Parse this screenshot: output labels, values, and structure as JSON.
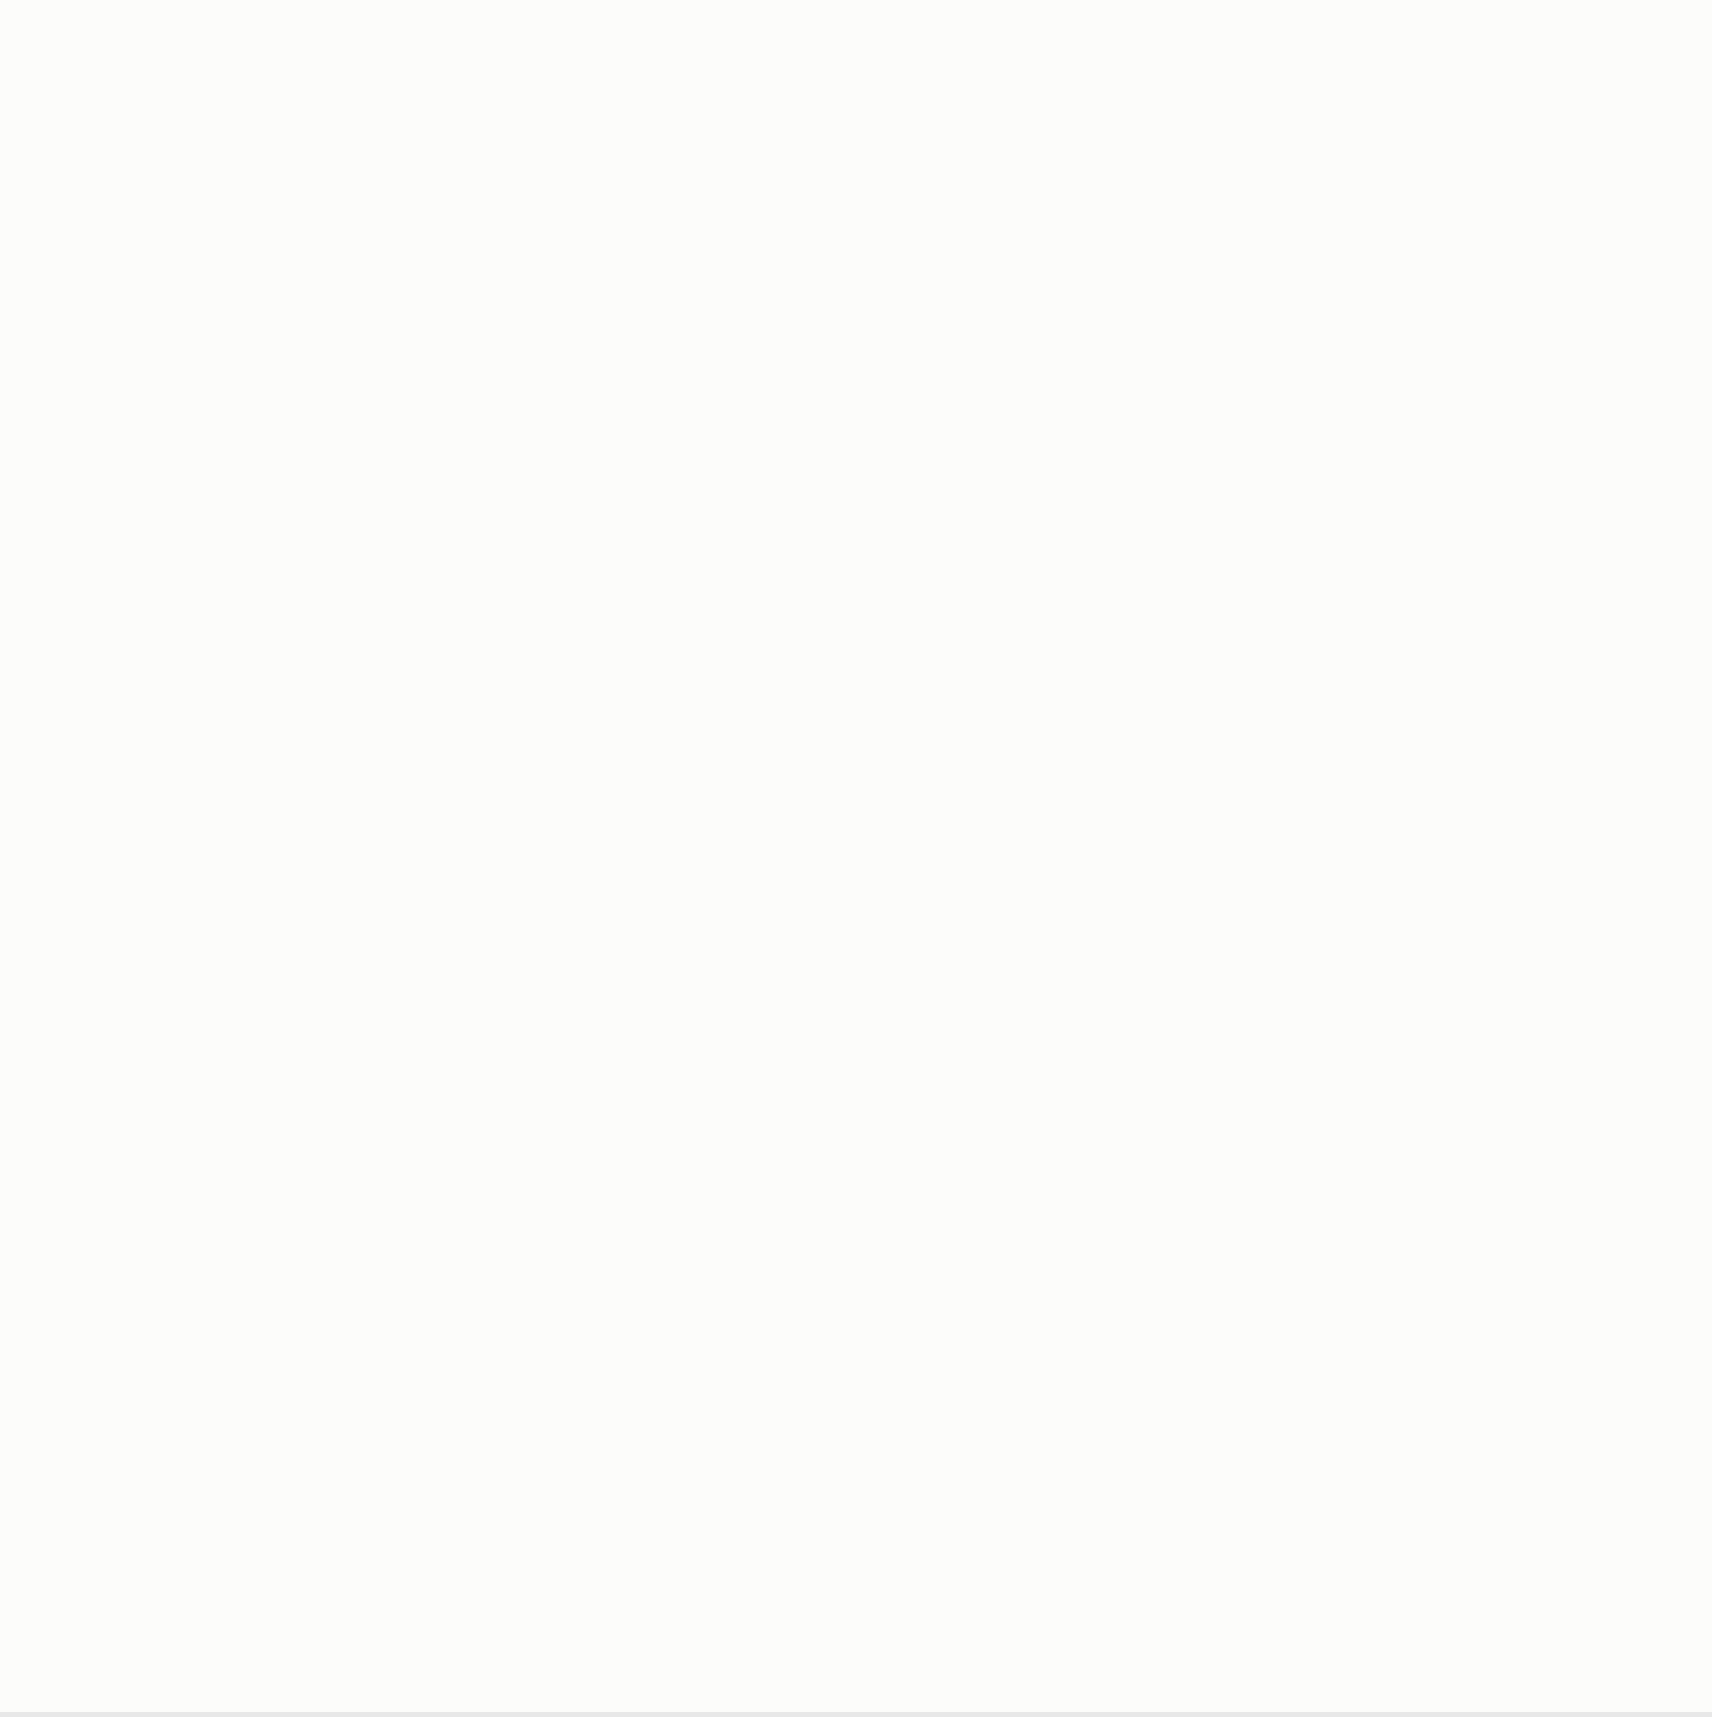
{
  "colors": {
    "red": "#d03224",
    "orange": "#e2801e",
    "magenta": "#c94fc0",
    "wall_blue": "#1e3f9e",
    "thin_blue": "#2f5fae",
    "hatch_gray": "#8f8f8f",
    "speckle_blue": "#79c0de",
    "pale_blue": "#d7e9f4",
    "ink": "#333333",
    "tree_green": "#6f9a60"
  },
  "labels": {
    "bosco_top": {
      "t": "BOSCO",
      "x": 578,
      "y": 16
    },
    "bosco_right": {
      "t": "BOSCO",
      "x": 1442,
      "y": 258
    },
    "parcel_1125": {
      "t": "1125",
      "x": 570,
      "y": 282,
      "rot": -80
    },
    "parcel_885": {
      "t": "885",
      "x": 1070,
      "y": 358,
      "rot": -76
    },
    "parcel_1122": {
      "t": "1122",
      "x": 506,
      "y": 1600,
      "rot": -73
    },
    "street": {
      "t": "Ronchetti",
      "x": 558,
      "y": 1612,
      "rot": -73
    },
    "north": {
      "t": "N",
      "x": 102,
      "y": 1503
    }
  },
  "markers": [
    {
      "t": "A",
      "x": 107,
      "y": 22,
      "o": "t"
    },
    {
      "t": "B",
      "x": 350,
      "y": 26,
      "o": "t"
    },
    {
      "t": "C",
      "x": 500,
      "y": 24,
      "o": "t"
    },
    {
      "t": "D",
      "x": 660,
      "y": 28,
      "o": "t"
    },
    {
      "t": "E",
      "x": 768,
      "y": 34,
      "o": "t"
    },
    {
      "t": "F",
      "x": 958,
      "y": 50,
      "o": "t"
    },
    {
      "t": "G",
      "x": 1100,
      "y": 53,
      "o": "t"
    },
    {
      "t": "H",
      "x": 1245,
      "y": 165,
      "o": "t"
    },
    {
      "t": "I",
      "x": 1432,
      "y": 322,
      "o": "t"
    },
    {
      "t": "L",
      "x": 1572,
      "y": 402,
      "o": "t"
    },
    {
      "t": "M",
      "x": 1592,
      "y": 502,
      "o": "r"
    },
    {
      "t": "N",
      "x": 1591,
      "y": 598,
      "o": "r"
    },
    {
      "t": "O",
      "x": 1594,
      "y": 838,
      "o": "r"
    },
    {
      "t": "P",
      "x": 1594,
      "y": 1005,
      "o": "r"
    },
    {
      "t": "Q",
      "x": 1600,
      "y": 1520,
      "o": "r"
    },
    {
      "t": "M",
      "x": 76,
      "y": 505,
      "o": "l"
    },
    {
      "t": "N",
      "x": 75,
      "y": 600,
      "o": "l"
    },
    {
      "t": "O",
      "x": 75,
      "y": 642,
      "o": "l"
    },
    {
      "t": "P",
      "x": 72,
      "y": 795,
      "o": "l"
    },
    {
      "t": "Q",
      "x": 68,
      "y": 1191,
      "o": "l"
    },
    {
      "t": "A",
      "x": 104,
      "y": 1304,
      "o": "l"
    },
    {
      "t": "B",
      "x": 344,
      "y": 1404,
      "o": "l"
    },
    {
      "t": "C",
      "x": 489,
      "y": 1442,
      "o": "b"
    },
    {
      "t": "D",
      "x": 650,
      "y": 1524,
      "o": "b"
    },
    {
      "t": "E",
      "x": 760,
      "y": 1567,
      "o": "b"
    },
    {
      "t": "F",
      "x": 954,
      "y": 1595,
      "o": "b"
    },
    {
      "t": "G",
      "x": 1104,
      "y": 1597,
      "o": "b"
    },
    {
      "t": "H",
      "x": 1277,
      "y": 1598,
      "o": "b"
    },
    {
      "t": "I",
      "x": 1475,
      "y": 1600,
      "o": "b"
    },
    {
      "t": "L",
      "x": 1570,
      "y": 1602,
      "o": "b"
    }
  ],
  "step_dims": [
    {
      "t": "605",
      "x": 305,
      "y": 516
    },
    {
      "t": "371",
      "x": 458,
      "y": 516
    },
    {
      "t": "514",
      "x": 641,
      "y": 516
    },
    {
      "t": "401",
      "x": 920,
      "y": 748
    },
    {
      "t": "571",
      "x": 1040,
      "y": 737
    },
    {
      "t": "514",
      "x": 1190,
      "y": 737
    },
    {
      "t": "411",
      "x": 1330,
      "y": 737
    }
  ],
  "colored_dims": [
    {
      "t": "293",
      "x": 150,
      "y": 884,
      "c": "red"
    },
    {
      "t": "290",
      "x": 1512,
      "y": 706,
      "c": "orange"
    },
    {
      "t": "490",
      "x": 391,
      "y": 1170,
      "c": "orange",
      "rot": -90
    },
    {
      "t": "490",
      "x": 1030,
      "y": 1300,
      "c": "orange",
      "rot": -90
    }
  ],
  "houses": [
    {
      "name": "CASA 1",
      "label": {
        "x": 330,
        "y": 1065
      },
      "variant": "A",
      "rect": {
        "x": 219,
        "y": 528,
        "w": 255,
        "h": 456
      },
      "level": "377,81",
      "level_pos": {
        "rx": 0.39,
        "ry": 0.455
      },
      "rooms": [
        {
          "t": [
            "cantina",
            "lavanderia",
            "10,5 mq"
          ],
          "rx": 0.27,
          "ry": 0.07
        },
        {
          "t": [
            "vano scala",
            "9,7 mq"
          ],
          "rx": 0.46,
          "ry": 0.35
        },
        {
          "t": [
            "atrio",
            "7,5 mq"
          ],
          "rx": 0.2,
          "ry": 0.46
        },
        {
          "t": [
            "corridoio",
            "4 mq"
          ],
          "rx": 0.43,
          "ry": 0.545
        },
        {
          "t": [
            "camera 1",
            "16 mq"
          ],
          "rx": 0.82,
          "ry": 0.455
        },
        {
          "t": [
            "bagno 1",
            "4,5 mq"
          ],
          "rx": 0.14,
          "ry": 0.66
        },
        {
          "t": [
            "bagno 2",
            "4,5 mq"
          ],
          "rx": 0.58,
          "ry": 0.66
        },
        {
          "t": [
            "camera 3",
            "12,5 mq"
          ],
          "rx": 0.215,
          "ry": 0.895
        },
        {
          "t": [
            "camera 2",
            "12,5 mq"
          ],
          "rx": 0.6,
          "ry": 0.895
        }
      ],
      "chains": {
        "top": [
          "40",
          "282,5",
          "92",
          "75,5",
          "46",
          "105",
          "50",
          "244",
          "61"
        ],
        "t94": "94",
        "mid": [
          "40",
          "276",
          "105",
          "69",
          "10",
          "401",
          "20"
        ],
        "bot": [
          "40",
          "302,5",
          "302,5",
          "40"
        ],
        "rot410": "410",
        "sub1": [
          "51",
          "175",
          "137,5",
          "175",
          "150,5"
        ],
        "sub2": [
          "215",
          "215"
        ],
        "width": "605"
      },
      "vdims": [
        {
          "t": "230",
          "rx": 0.585,
          "ry": 0.135
        },
        {
          "t": "216",
          "rx": 0.455,
          "ry": 0.315
        },
        {
          "t": "265",
          "rx": 0.575,
          "ry": 0.335
        },
        {
          "t": "266",
          "rx": 0.625,
          "ry": 0.38
        },
        {
          "t": "170",
          "rx": 0.335,
          "ry": 0.5
        },
        {
          "t": "92",
          "rx": 0.655,
          "ry": 0.47
        }
      ],
      "out": [
        {
          "t": "1356",
          "x": 204,
          "y": 812,
          "rot": -90
        },
        {
          "t": "451",
          "x": 209,
          "y": 1140,
          "rot": -90
        },
        {
          "t": "149",
          "x": 196,
          "y": 762,
          "rot": -90,
          "s": 7
        },
        {
          "t": "74",
          "x": 205,
          "y": 762,
          "rot": -90,
          "s": 7
        },
        {
          "t": "140",
          "x": 196,
          "y": 893,
          "rot": -90,
          "s": 7
        },
        {
          "t": "74",
          "x": 205,
          "y": 893,
          "rot": -90,
          "s": 7
        },
        {
          "t": "125",
          "x": 497,
          "y": 800,
          "s": 7
        },
        {
          "t": "215",
          "x": 497,
          "y": 809,
          "s": 7
        }
      ]
    },
    {
      "name": "CASA 2",
      "label": {
        "x": 640,
        "y": 1069
      },
      "variant": "B",
      "rect": {
        "x": 517,
        "y": 528,
        "w": 255,
        "h": 456
      },
      "level": "377,51",
      "level_pos": {
        "rx": 0.41,
        "ry": 0.6
      },
      "rooms": [
        {
          "t": [
            "cantina",
            "lavanderia",
            "10,5 mq"
          ],
          "rx": 0.27,
          "ry": 0.07
        },
        {
          "t": [
            "vano scala",
            "9,7 mq"
          ],
          "rx": 0.49,
          "ry": 0.35
        },
        {
          "t": [
            "bagno 2",
            "4,5 mq"
          ],
          "rx": 0.24,
          "ry": 0.47
        },
        {
          "t": [
            "corridoio",
            "3 mq"
          ],
          "rx": 0.48,
          "ry": 0.515
        },
        {
          "t": [
            "camera 1",
            "16 mq"
          ],
          "rx": 0.85,
          "ry": 0.455
        },
        {
          "t": [
            "atrio",
            "5,5 mq"
          ],
          "rx": 0.24,
          "ry": 0.625
        },
        {
          "t": [
            "bagno 1",
            "4,5 mq"
          ],
          "rx": 0.73,
          "ry": 0.655
        },
        {
          "t": [
            "camera 3",
            "12,5 mq"
          ],
          "rx": 0.21,
          "ry": 0.895
        },
        {
          "t": [
            "camera 2",
            "12,5 mq"
          ],
          "rx": 0.57,
          "ry": 0.895
        }
      ],
      "chains": {
        "top": [
          "40",
          "282,5",
          "92",
          "75,5",
          "46",
          "105",
          "50",
          "244",
          "81"
        ],
        "t94": "94",
        "mid": [
          "20",
          "276",
          "105",
          "174",
          "10",
          "401",
          "20"
        ],
        "bot": [
          "40",
          "302,5",
          "302,5",
          "40"
        ],
        "rot410": "410",
        "sub1": [
          "51",
          "175",
          "137,5",
          "175",
          "150,5"
        ],
        "sub2": [
          "215",
          "215"
        ],
        "width": "605"
      },
      "vdims": [
        {
          "t": "135",
          "rx": 0.585,
          "ry": 0.135
        },
        {
          "t": "216",
          "rx": 0.455,
          "ry": 0.315
        },
        {
          "t": "265",
          "rx": 0.575,
          "ry": 0.335
        },
        {
          "t": "266",
          "rx": 0.625,
          "ry": 0.38
        },
        {
          "t": "170",
          "rx": 0.335,
          "ry": 0.5
        },
        {
          "t": "105",
          "rx": 0.655,
          "ry": 0.47
        }
      ],
      "out": [
        {
          "t": "640",
          "x": 786,
          "y": 818,
          "rot": -90
        },
        {
          "t": "492",
          "x": 772,
          "y": 908,
          "rot": -90
        },
        {
          "t": "459",
          "x": 800,
          "y": 862,
          "rot": -90
        },
        {
          "t": "656",
          "x": 719,
          "y": 1182,
          "rot": -90
        },
        {
          "t": "610",
          "x": 824,
          "y": 1182,
          "rot": -90
        }
      ]
    },
    {
      "name": "CASA 3",
      "label": {
        "x": 940,
        "y": 1300
      },
      "variant": "A",
      "rect": {
        "x": 837,
        "y": 770,
        "w": 255,
        "h": 456
      },
      "level": "377,81",
      "level_pos": {
        "rx": 0.34,
        "ry": 0.445
      },
      "rooms": [
        {
          "t": [
            "cantina",
            "lavanderia",
            "10,5 mq"
          ],
          "rx": 0.22,
          "ry": 0.07
        },
        {
          "t": [
            "vano scala",
            "9,7 mq"
          ],
          "rx": 0.44,
          "ry": 0.345
        },
        {
          "t": [
            "atrio",
            "7,5 mq"
          ],
          "rx": 0.18,
          "ry": 0.46
        },
        {
          "t": [
            "corridoio",
            "4 mq"
          ],
          "rx": 0.355,
          "ry": 0.625
        },
        {
          "t": [
            "camera 1",
            "16 mq"
          ],
          "rx": 0.835,
          "ry": 0.455,
          "c": "#2b6bd0"
        },
        {
          "t": [
            "bagno 2",
            "4,5 mq"
          ],
          "rx": 0.135,
          "ry": 0.64
        },
        {
          "t": [
            "bagno 1",
            "4,5 mq"
          ],
          "rx": 0.675,
          "ry": 0.64
        },
        {
          "t": [
            "camera 3",
            "12,5 mq"
          ],
          "rx": 0.205,
          "ry": 0.885
        },
        {
          "t": [
            "camera 2",
            "12,5 mq"
          ],
          "rx": 0.59,
          "ry": 0.885
        }
      ],
      "chains": {
        "top": [
          "40",
          "282,5",
          "92",
          "75,5",
          "46",
          "105",
          "50",
          "244",
          "61"
        ],
        "t94": "94",
        "mid": [
          "40",
          "276",
          "105",
          "69",
          "10",
          "401",
          "20"
        ],
        "bot": [
          "40",
          "302,5",
          "302,5",
          "40"
        ],
        "rot410": "410",
        "sub1": [
          "51",
          "175",
          "137,5",
          "175",
          "150,5"
        ],
        "sub2": [
          "215",
          "215"
        ],
        "width": "695"
      },
      "vdims": [
        {
          "t": "135",
          "rx": 0.585,
          "ry": 0.135
        },
        {
          "t": "216",
          "rx": 0.455,
          "ry": 0.315
        },
        {
          "t": "265",
          "rx": 0.575,
          "ry": 0.335
        },
        {
          "t": "266",
          "rx": 0.625,
          "ry": 0.38
        },
        {
          "t": "170",
          "rx": 0.335,
          "ry": 0.5
        },
        {
          "t": "92",
          "rx": 0.655,
          "ry": 0.47
        }
      ],
      "out": [
        {
          "t": "125",
          "x": 1100,
          "y": 1002,
          "s": 7
        },
        {
          "t": "215",
          "x": 1100,
          "y": 1011,
          "s": 7
        },
        {
          "t": "210",
          "x": 745,
          "y": 1080,
          "rot": -90
        }
      ]
    },
    {
      "name": "CASA 4",
      "label": {
        "x": 1230,
        "y": 1300
      },
      "variant": "B",
      "rect": {
        "x": 1135,
        "y": 770,
        "w": 255,
        "h": 456
      },
      "level": "378,11",
      "level_pos": {
        "rx": 0.35,
        "ry": 0.575
      },
      "rooms": [
        {
          "t": [
            "cantina",
            "lavanderia",
            "10,5 mq"
          ],
          "rx": 0.22,
          "ry": 0.07
        },
        {
          "t": [
            "vano scala",
            "9,7 mq"
          ],
          "rx": 0.44,
          "ry": 0.345
        },
        {
          "t": [
            "bagno 2",
            "4,5 mq"
          ],
          "rx": 0.195,
          "ry": 0.45
        },
        {
          "t": [
            "corridoio",
            "3 mq"
          ],
          "rx": 0.447,
          "ry": 0.5
        },
        {
          "t": [
            "camera 1",
            "16 mq"
          ],
          "rx": 0.805,
          "ry": 0.46
        },
        {
          "t": [
            "atrio",
            "8,5 mq"
          ],
          "rx": 0.19,
          "ry": 0.59
        },
        {
          "t": [
            "bagno 1",
            "4,5 mq"
          ],
          "rx": 0.65,
          "ry": 0.645
        },
        {
          "t": [
            "camera 3",
            "12,5 mq"
          ],
          "rx": 0.37,
          "ry": 0.885
        },
        {
          "t": [
            "camera 2",
            "12,5 mq"
          ],
          "rx": 0.765,
          "ry": 0.885
        }
      ],
      "chains": {
        "top": [
          "40",
          "262,5",
          "92",
          "75,5",
          "46",
          "105",
          "50",
          "244",
          "121"
        ],
        "t94": "94",
        "mid": [
          "20",
          "276",
          "105",
          "74",
          "10",
          "401",
          "20"
        ],
        "bot": [
          "40",
          "302,5",
          "302,5",
          "40"
        ],
        "rot410": "410",
        "sub1": [
          "51",
          "175",
          "137,5",
          "175",
          "150,5"
        ],
        "sub2": [
          "215",
          "215"
        ],
        "width": "695"
      },
      "vdims": [
        {
          "t": "135",
          "rx": 0.585,
          "ry": 0.135
        },
        {
          "t": "216",
          "rx": 0.455,
          "ry": 0.315
        },
        {
          "t": "265",
          "rx": 0.575,
          "ry": 0.335
        },
        {
          "t": "266",
          "rx": 0.625,
          "ry": 0.38
        },
        {
          "t": "170",
          "rx": 0.335,
          "ry": 0.5
        },
        {
          "t": "102",
          "rx": 0.655,
          "ry": 0.47
        }
      ],
      "out": [
        {
          "t": "640",
          "x": 1402,
          "y": 962,
          "rot": -90
        },
        {
          "t": "492",
          "x": 1416,
          "y": 1062,
          "rot": -90
        },
        {
          "t": "246",
          "x": 1404,
          "y": 1256
        },
        {
          "t": "121",
          "x": 1352,
          "y": 940,
          "s": 7
        }
      ]
    }
  ]
}
